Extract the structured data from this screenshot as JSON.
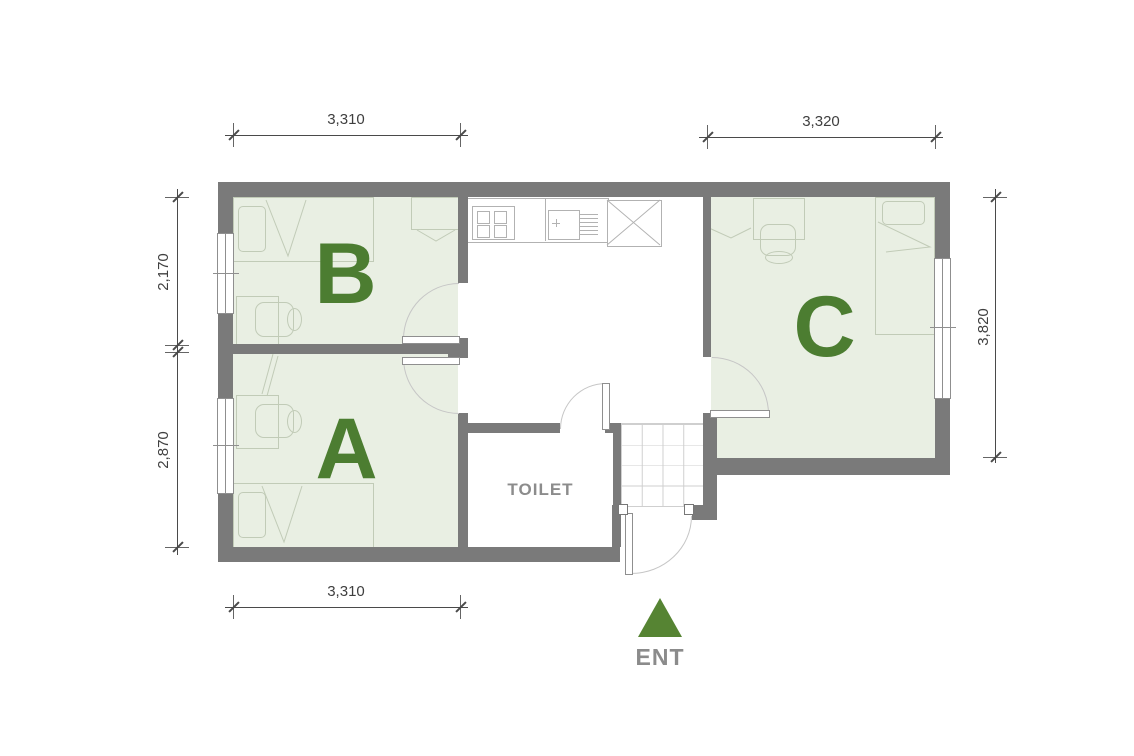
{
  "colors": {
    "wall": "#7a7a7a",
    "room-fill": "#e9efe3",
    "accent-green": "#4c7d31",
    "ent-green": "#568433",
    "furniture-line": "#c1cbb7",
    "fixture-line": "#b2b2b2",
    "tile-line": "#cfcfcf",
    "door-line": "#8f8f8f",
    "arc-line": "#c6c6c6",
    "dim-line": "#4a4a4a",
    "dim-text": "#3f3f3f",
    "muted-text": "#8c8c8c",
    "ent-text": "#8b8b8b"
  },
  "rooms": {
    "b": {
      "label": "B"
    },
    "a": {
      "label": "A"
    },
    "c": {
      "label": "C"
    },
    "toilet": {
      "label": "TOILET"
    }
  },
  "entrance": {
    "label": "ENT"
  },
  "dimensions": {
    "top_left": "3,310",
    "top_right": "3,320",
    "bottom": "3,310",
    "left_upper": "2,170",
    "left_lower": "2,870",
    "right": "3,820"
  }
}
